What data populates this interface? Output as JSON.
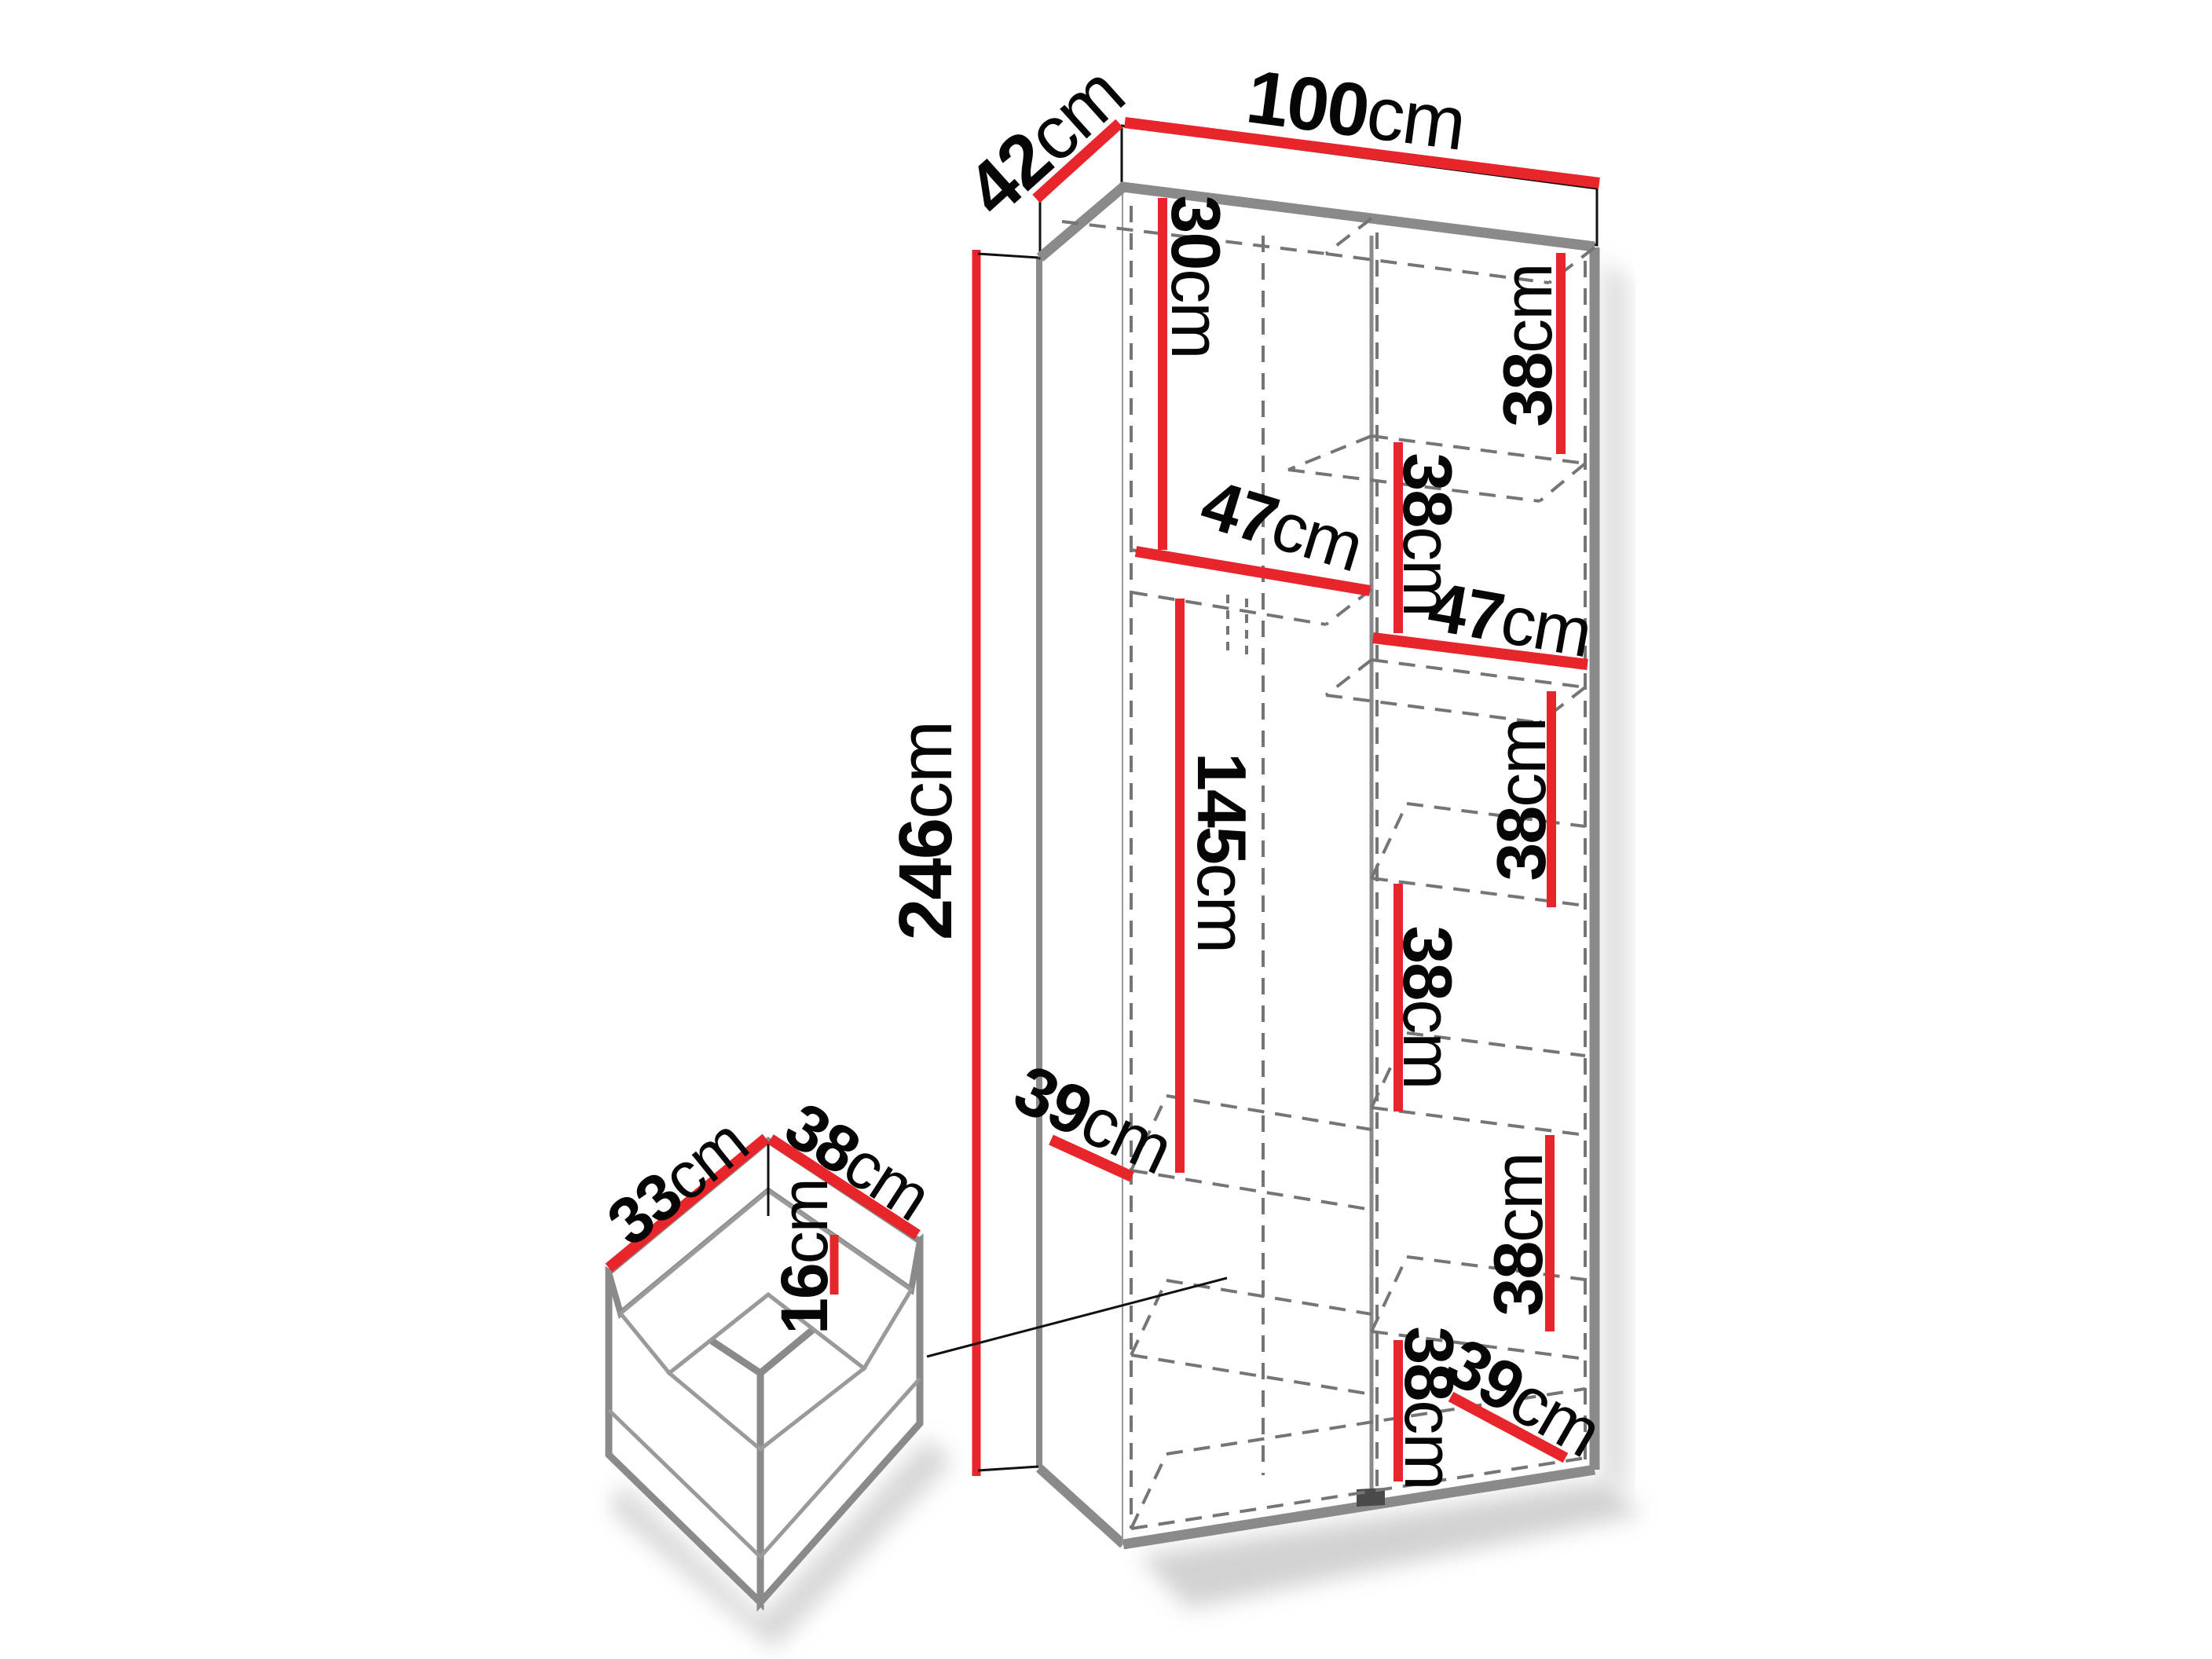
{
  "diagram": {
    "type": "furniture-dimension-drawing",
    "unit": "cm",
    "wardrobe": {
      "exterior": {
        "depth": {
          "v": "42",
          "u": "cm"
        },
        "width": {
          "v": "100",
          "u": "cm"
        },
        "height": {
          "v": "246",
          "u": "cm"
        }
      },
      "left_column": {
        "top_gap": {
          "v": "30",
          "u": "cm"
        },
        "shelf_width": {
          "v": "47",
          "u": "cm"
        },
        "hanging_height": {
          "v": "145",
          "u": "cm"
        },
        "shelf_depth": {
          "v": "39",
          "u": "cm"
        }
      },
      "right_column": {
        "shelf_width": {
          "v": "47",
          "u": "cm"
        },
        "shelf_depth": {
          "v": "39",
          "u": "cm"
        },
        "cells": [
          {
            "v": "38",
            "u": "cm"
          },
          {
            "v": "38",
            "u": "cm"
          },
          {
            "v": "38",
            "u": "cm"
          },
          {
            "v": "38",
            "u": "cm"
          },
          {
            "v": "38",
            "u": "cm"
          },
          {
            "v": "38",
            "u": "cm"
          }
        ]
      }
    },
    "drawer": {
      "depth": {
        "v": "33",
        "u": "cm"
      },
      "width": {
        "v": "38",
        "u": "cm"
      },
      "height": {
        "v": "16",
        "u": "cm"
      }
    },
    "colors": {
      "dimension_accent": "#e8252a",
      "structure_edge": "#8a8a8a",
      "hidden_line": "#757575",
      "ink": "#060606",
      "background": "#ffffff"
    }
  }
}
